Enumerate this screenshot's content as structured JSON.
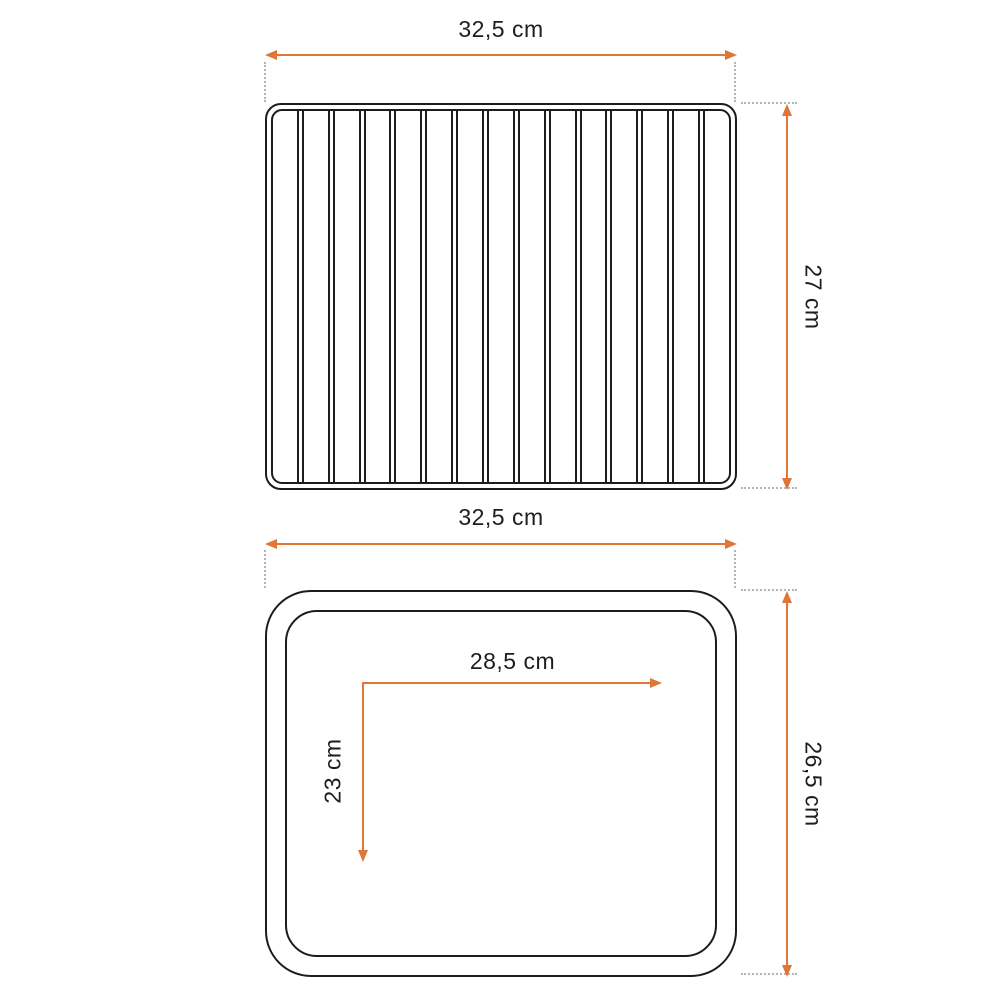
{
  "colors": {
    "accent": "#df7536",
    "outline": "#1c1c1c",
    "guide": "#b5b5b5",
    "text": "#1d1d1d",
    "background": "#ffffff"
  },
  "top_view": {
    "width_dim": {
      "label": "32,5 cm"
    },
    "height_dim": {
      "label": "27 cm"
    },
    "bar_count": 14
  },
  "bottom_view": {
    "width_dim": {
      "label": "32,5 cm"
    },
    "height_dim": {
      "label": "26,5 cm"
    },
    "inner_width_dim": {
      "label": "28,5 cm"
    },
    "inner_height_dim": {
      "label": "23 cm"
    }
  }
}
